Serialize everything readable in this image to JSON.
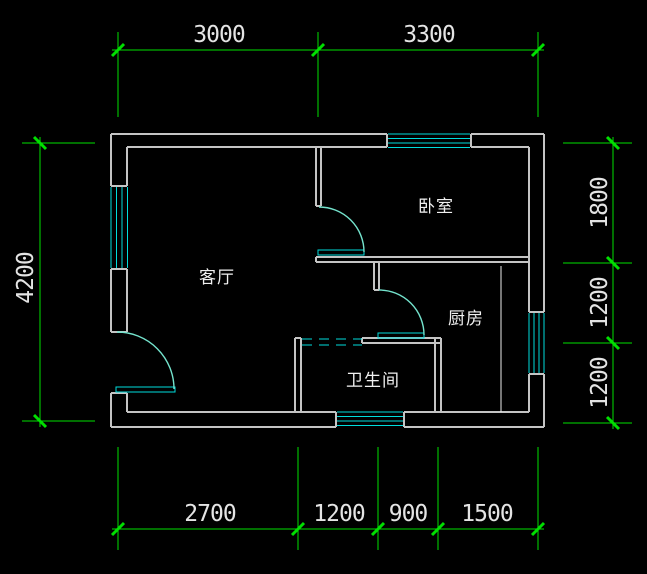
{
  "drawing_type": "apartment-floor-plan",
  "colors": {
    "background": "#000000",
    "wall": "#C4C4C4",
    "window_door": "#00DCDC",
    "door_arc": "#74E3CD",
    "dimension_line": "#00DF00",
    "dimension_text": "#E4E4E4",
    "room_text": "#F0F0F0"
  },
  "rooms": {
    "living_room": "客厅",
    "bedroom": "卧室",
    "kitchen": "厨房",
    "bathroom": "卫生间"
  },
  "dimensions_mm": {
    "top": [
      "3000",
      "3300"
    ],
    "bottom": [
      "2700",
      "1200",
      "900",
      "1500"
    ],
    "left": [
      "4200"
    ],
    "right": [
      "1800",
      "1200",
      "1200"
    ]
  }
}
